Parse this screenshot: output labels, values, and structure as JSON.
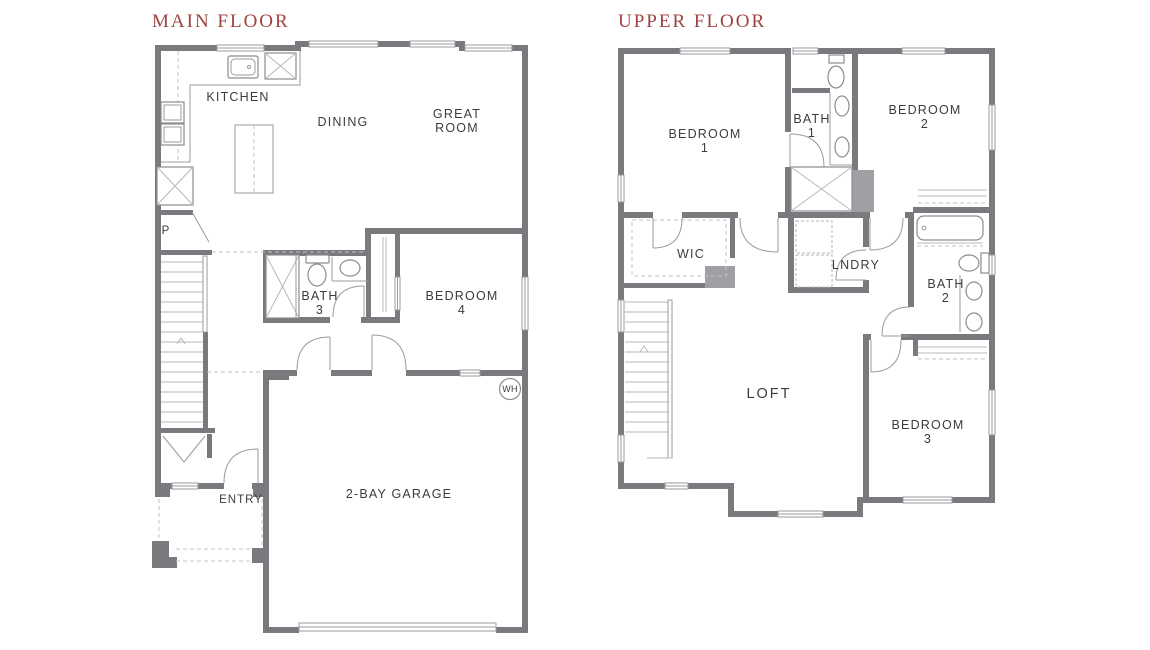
{
  "page": {
    "background": "#ffffff"
  },
  "colors": {
    "title_red": "#9e4340",
    "wall_gray": "#797a7d",
    "chase_gray": "#9fa0a3",
    "line_gray": "#9a9b9e",
    "dash_gray": "#c2c3c5",
    "label_text": "#3c3c3e"
  },
  "main_floor": {
    "title": "MAIN FLOOR",
    "rooms": {
      "kitchen": "KITCHEN",
      "dining": "DINING",
      "great_room": [
        "GREAT",
        "ROOM"
      ],
      "pantry": "P",
      "bath3": [
        "BATH",
        "3"
      ],
      "bedroom4": [
        "BEDROOM",
        "4"
      ],
      "water_heater": "WH",
      "entry": "ENTRY",
      "garage": "2-BAY GARAGE"
    }
  },
  "upper_floor": {
    "title": "UPPER FLOOR",
    "rooms": {
      "bedroom1": [
        "BEDROOM",
        "1"
      ],
      "bath1": [
        "BATH",
        "1"
      ],
      "bedroom2": [
        "BEDROOM",
        "2"
      ],
      "wic": "WIC",
      "laundry": "LNDRY",
      "bath2": [
        "BATH",
        "2"
      ],
      "loft": "LOFT",
      "bedroom3": [
        "BEDROOM",
        "3"
      ]
    }
  }
}
